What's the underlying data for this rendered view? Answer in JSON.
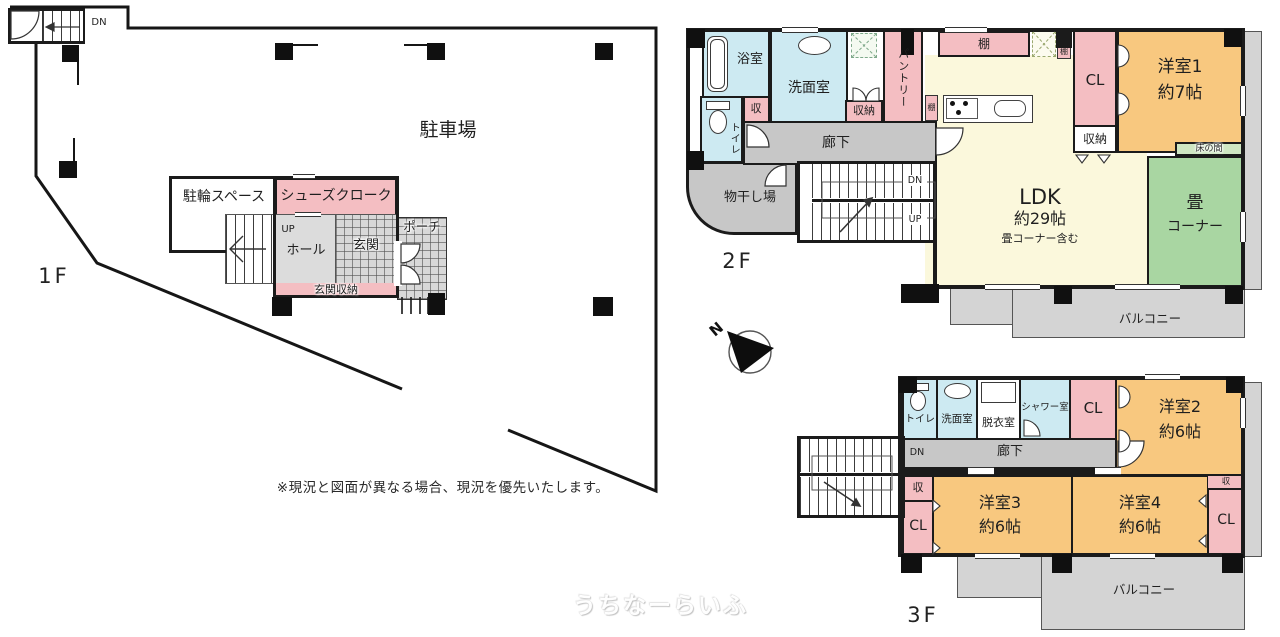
{
  "colors": {
    "wall": "#1b1b1b",
    "pink": "#f4bec2",
    "cyan": "#cdeaf2",
    "orange": "#f8c87f",
    "yellow": "#fbf8dc",
    "green": "#a9d6a2",
    "toko": "#cfe7c3",
    "grayfloor": "#c7c7c7",
    "balcony": "#d4d4d4",
    "hatch": "#d8d8d8"
  },
  "f1": {
    "floor": "1F",
    "parking": "駐車場",
    "bike": "駐輪スペース",
    "shoes": "シューズクローク",
    "up": "UP",
    "dn": "DN",
    "hall": "ホール",
    "genkan": "玄関",
    "porch": "ポーチ",
    "genkan_sto": "玄関収納"
  },
  "f2": {
    "floor": "2F",
    "bath": "浴室",
    "wash": "洗面室",
    "sto": "収",
    "stono": "収納",
    "pantry": "パントリー",
    "tana": "棚",
    "toilet": "トイレ",
    "rouka": "廊下",
    "monohoshi": "物干し場",
    "dn": "DN",
    "up": "UP",
    "cl": "CL",
    "yo1a": "洋室1",
    "yo1b": "約7帖",
    "toko": "床の間",
    "ldka": "LDK",
    "ldkb": "約29帖",
    "ldkc": "畳コーナー含む",
    "tata": "畳",
    "tatb": "コーナー",
    "balcony": "バルコニー"
  },
  "f3": {
    "floor": "3F",
    "toilet": "トイレ",
    "wash": "洗面室",
    "datsui": "脱衣室",
    "shower": "シャワー室",
    "cl": "CL",
    "yo2a": "洋室2",
    "yo2b": "約6帖",
    "rouka": "廊下",
    "dn": "DN",
    "sto": "収",
    "yo3a": "洋室3",
    "yo3b": "約6帖",
    "yo4a": "洋室4",
    "yo4b": "約6帖",
    "balcony": "バルコニー"
  },
  "compass": {
    "n": "N"
  },
  "note": "※現況と図面が異なる場合、現況を優先いたします。",
  "watermark": "うちなーらいふ"
}
